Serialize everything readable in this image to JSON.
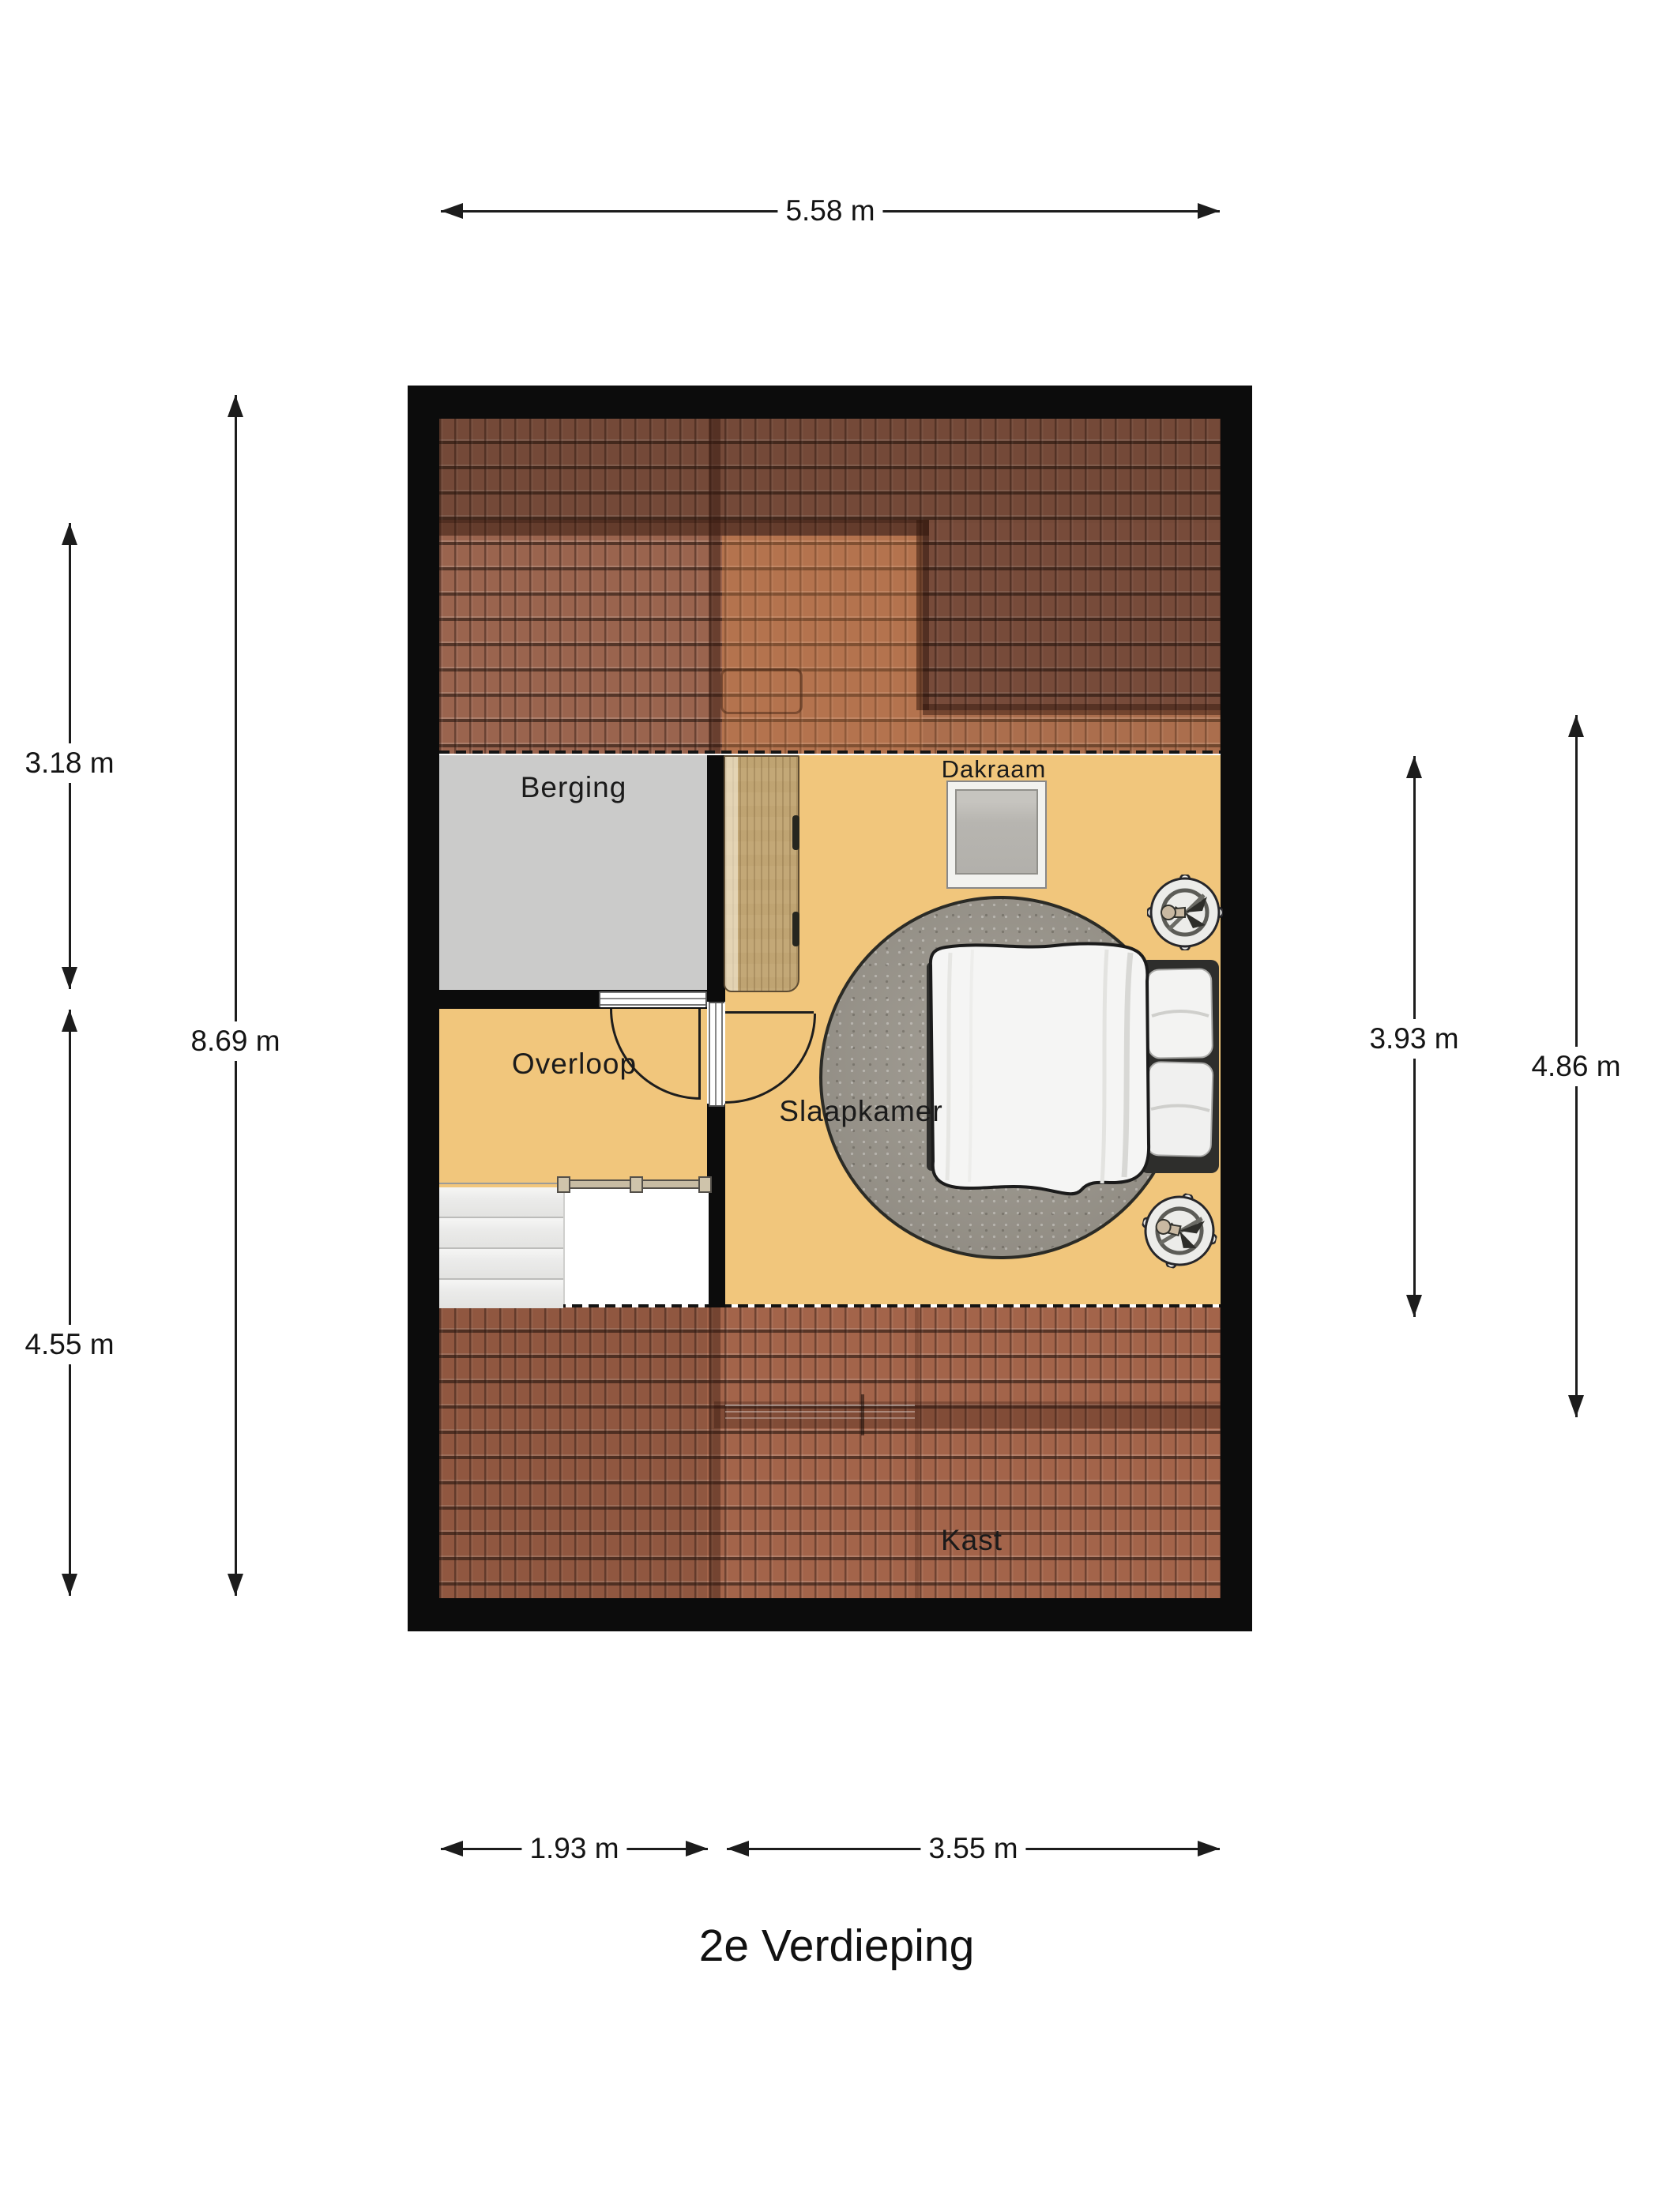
{
  "title": "2e Verdieping",
  "rooms": {
    "berging": {
      "label": "Berging"
    },
    "overloop": {
      "label": "Overloop"
    },
    "slaapkamer": {
      "label": "Slaapkamer"
    },
    "kast": {
      "label": "Kast"
    }
  },
  "features": {
    "dakraam": {
      "label": "Dakraam"
    }
  },
  "dimensions": {
    "top_width": "5.58 m",
    "left_upper": "3.18 m",
    "left_total": "8.69 m",
    "left_lower": "4.55 m",
    "right_room": "3.93 m",
    "right_total": "4.86 m",
    "bottom_left": "1.93 m",
    "bottom_right": "3.55 m"
  },
  "colors": {
    "wall": "#0c0c0c",
    "floor": "#f1c67c",
    "berging_floor": "#cbcbca",
    "roof_tile": "#9a644e",
    "roof_tile_bottom": "#a3644a",
    "rug": "#9b968c",
    "wardrobe_wood": "#c3a877",
    "skylight_glass": "#b7b5b0",
    "dimension_text": "#141414"
  },
  "icons": {
    "plant": "potted-plant-top-view",
    "bed": "double-bed-top-view",
    "stairs": "staircase-top-view"
  }
}
